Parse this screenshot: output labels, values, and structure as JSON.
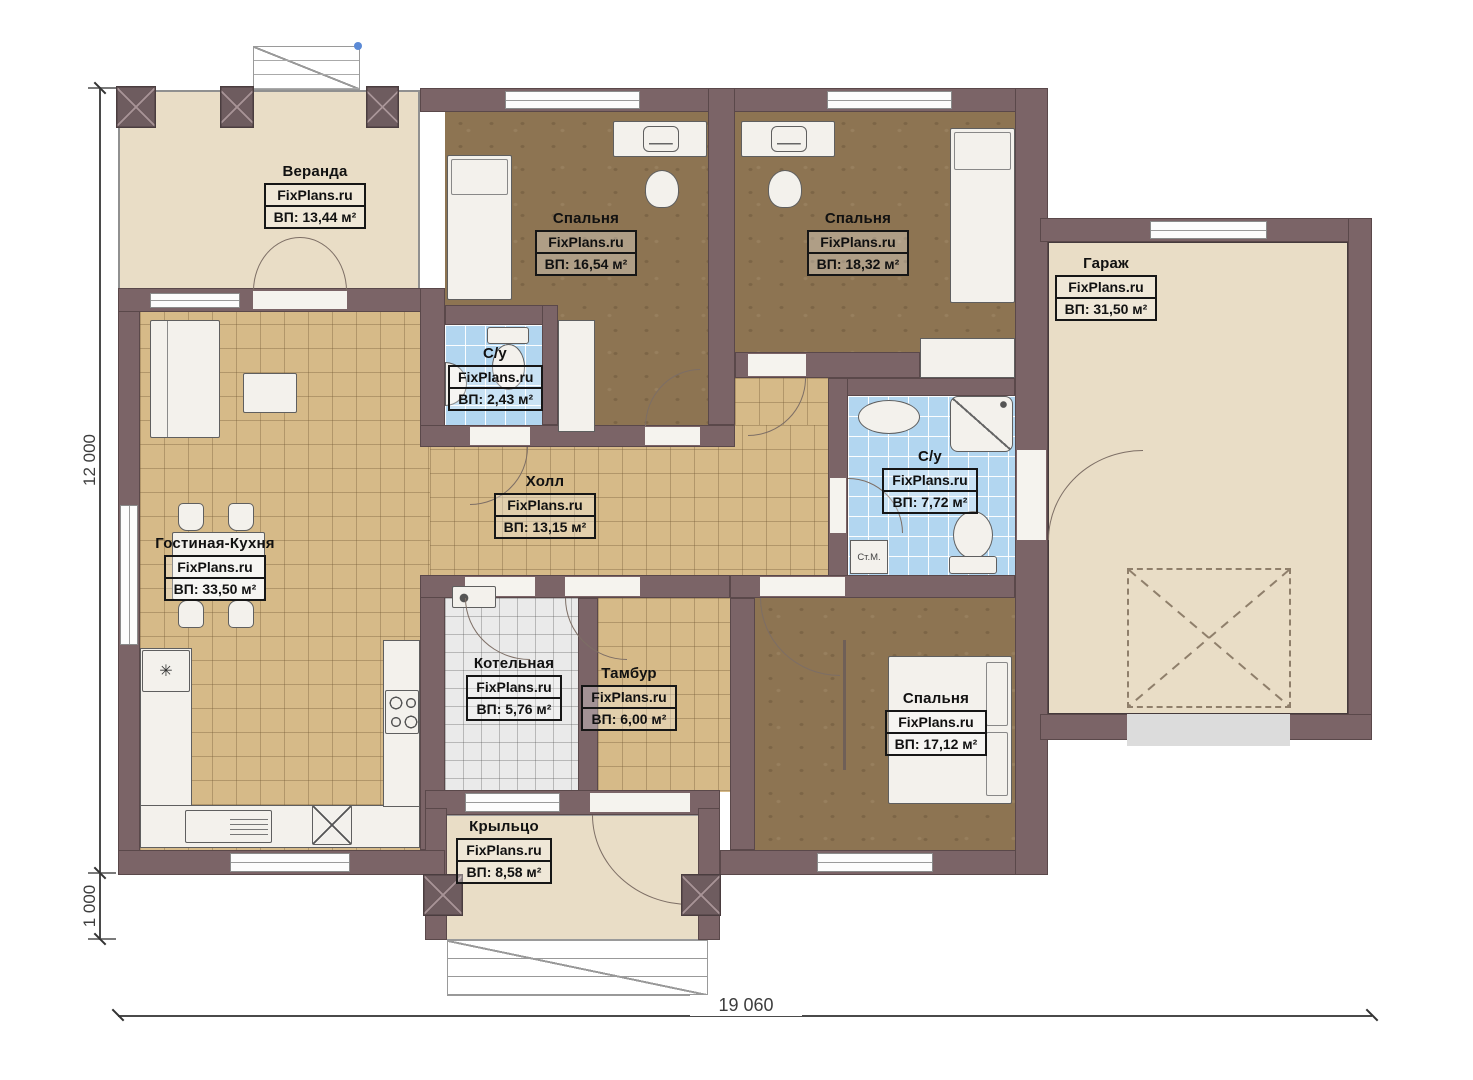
{
  "watermark": "FixPlans.ru",
  "rooms": {
    "veranda": {
      "name": "Веранда",
      "area": "ВП: 13,44 м²"
    },
    "bedroom1": {
      "name": "Спальня",
      "area": "ВП: 16,54 м²"
    },
    "bedroom2": {
      "name": "Спальня",
      "area": "ВП: 18,32 м²"
    },
    "garage": {
      "name": "Гараж",
      "area": "ВП: 31,50 м²"
    },
    "bathroom_small": {
      "name": "С/у",
      "area": "ВП: 2,43 м²"
    },
    "bathroom_large": {
      "name": "С/у",
      "area": "ВП: 7,72 м²"
    },
    "hall": {
      "name": "Холл",
      "area": "ВП: 13,15 м²"
    },
    "living_kitchen": {
      "name": "Гостиная-Кухня",
      "area": "ВП: 33,50 м²"
    },
    "boiler": {
      "name": "Котельная",
      "area": "ВП: 5,76 м²"
    },
    "vestibule": {
      "name": "Тамбур",
      "area": "ВП: 6,00 м²"
    },
    "bedroom3": {
      "name": "Спальня",
      "area": "ВП: 17,12 м²"
    },
    "porch": {
      "name": "Крыльцо",
      "area": "ВП: 8,58 м²"
    }
  },
  "dimensions": {
    "height_main": "12 000",
    "height_porch": "1 000",
    "width_total": "19 060"
  },
  "annotations": {
    "washing_machine": "Ст.М."
  },
  "icons": {
    "sink": "✳"
  },
  "colors": {
    "wall": "#7b6467",
    "floor_tile": "#d6ba88",
    "floor_wood": "#8d7452",
    "floor_beige": "#e9ddc6",
    "floor_bath": "#b2d6f0",
    "floor_boiler": "#eaeaea"
  }
}
